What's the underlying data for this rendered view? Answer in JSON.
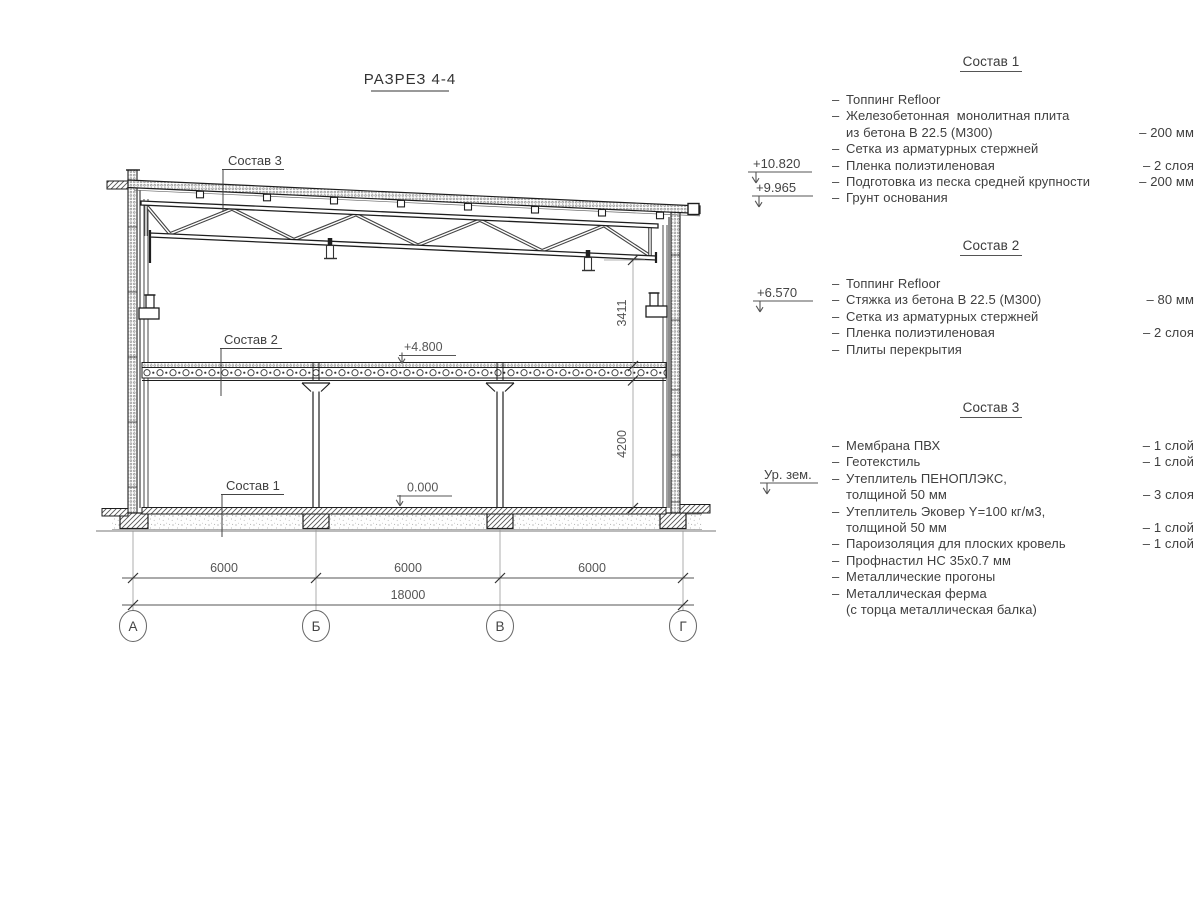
{
  "title": "РАЗРЕЗ 4-4",
  "drawing_labels": {
    "sostav1": "Состав 1",
    "sostav2": "Состав 2",
    "sostav3": "Состав 3"
  },
  "elevations": {
    "roof_high": "+10.820",
    "roof_low": "+9.965",
    "crane_level": "+6.570",
    "ground_level": "Ур. зем.",
    "floor_level": "+4.800",
    "zero_level": "0.000"
  },
  "dimensions": {
    "span1": "6000",
    "span2": "6000",
    "span3": "6000",
    "total": "18000",
    "upper_height": "3411",
    "lower_height": "4200"
  },
  "axes": [
    "А",
    "Б",
    "В",
    "Г"
  ],
  "compositions": [
    {
      "title": "Состав 1",
      "rows": [
        {
          "dash": "–",
          "text": "Топпинг Refloor",
          "value": ""
        },
        {
          "dash": "–",
          "text": "Железобетонная  монолитная плита",
          "value": ""
        },
        {
          "dash": "",
          "text": "из бетона В 22.5 (М300)",
          "value": "– 200 мм"
        },
        {
          "dash": "–",
          "text": "Сетка из арматурных стержней",
          "value": ""
        },
        {
          "dash": "–",
          "text": "Пленка полиэтиленовая",
          "value": "– 2 слоя"
        },
        {
          "dash": "–",
          "text": "Подготовка из песка средней крупности",
          "value": "– 200 мм"
        },
        {
          "dash": "–",
          "text": "Грунт основания",
          "value": ""
        }
      ]
    },
    {
      "title": "Состав 2",
      "rows": [
        {
          "dash": "–",
          "text": "Топпинг Refloor",
          "value": ""
        },
        {
          "dash": "–",
          "text": "Стяжка из бетона В 22.5 (М300)",
          "value": "– 80 мм"
        },
        {
          "dash": "–",
          "text": "Сетка из арматурных стержней",
          "value": ""
        },
        {
          "dash": "–",
          "text": "Пленка полиэтиленовая",
          "value": "– 2 слоя"
        },
        {
          "dash": "–",
          "text": "Плиты перекрытия",
          "value": ""
        }
      ]
    },
    {
      "title": "Состав 3",
      "rows": [
        {
          "dash": "–",
          "text": "Мембрана ПВХ",
          "value": "– 1 слой"
        },
        {
          "dash": "–",
          "text": "Геотекстиль",
          "value": "– 1 слой"
        },
        {
          "dash": "–",
          "text": "Утеплитель ПЕНОПЛЭКС,",
          "value": ""
        },
        {
          "dash": "",
          "text": "толщиной 50 мм",
          "value": "– 3 слоя"
        },
        {
          "dash": "–",
          "text": "Утеплитель Эковер Y=100 кг/м3,",
          "value": ""
        },
        {
          "dash": "",
          "text": "толщиной 50 мм",
          "value": "– 1 слой"
        },
        {
          "dash": "–",
          "text": "Пароизоляция для плоских кровель",
          "value": "– 1 слой"
        },
        {
          "dash": "–",
          "text": "Профнастил НС 35х0.7 мм",
          "value": ""
        },
        {
          "dash": "–",
          "text": "Металлические прогоны",
          "value": ""
        },
        {
          "dash": "–",
          "text": "Металлическая ферма",
          "value": ""
        },
        {
          "dash": "",
          "text": "(с торца металлическая балка)",
          "value": ""
        }
      ]
    }
  ],
  "colors": {
    "line_dark": "#1e1e1e",
    "line_dim": "#555555",
    "text": "#3f3f3f",
    "background": "#ffffff"
  }
}
